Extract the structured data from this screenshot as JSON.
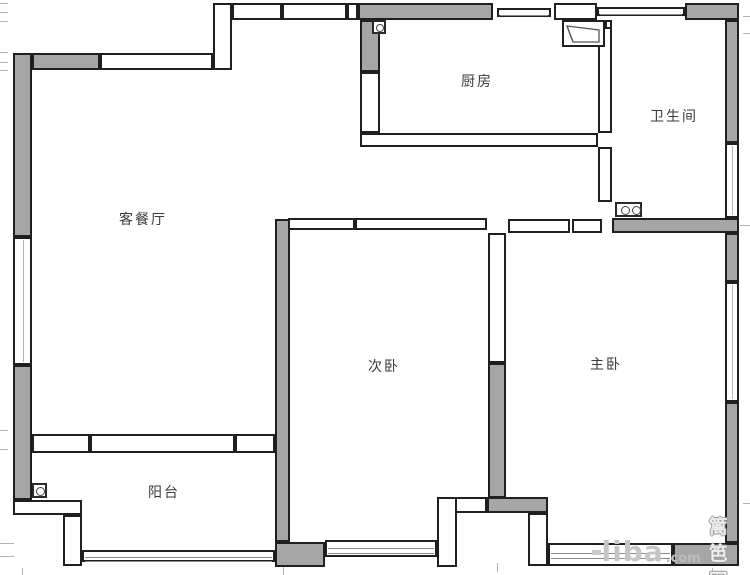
{
  "canvas": {
    "width": 750,
    "height": 575,
    "background": "#ffffff"
  },
  "colors": {
    "wall_fill": "#a6a6a6",
    "line": "#1f1f1f",
    "hollow_fill": "#ffffff",
    "tick": "#b3b3b3",
    "label": "#3a3a3a",
    "watermark_gray": "#c6c6c6"
  },
  "rooms": [
    {
      "id": "living-dining",
      "label": "客餐厅",
      "cx": 143,
      "cy": 219
    },
    {
      "id": "kitchen",
      "label": "厨房",
      "cx": 477,
      "cy": 81
    },
    {
      "id": "bathroom",
      "label": "卫生间",
      "cx": 674,
      "cy": 116
    },
    {
      "id": "second-bedroom",
      "label": "次卧",
      "cx": 384,
      "cy": 366
    },
    {
      "id": "master-bedroom",
      "label": "主卧",
      "cx": 606,
      "cy": 364
    },
    {
      "id": "balcony",
      "label": "阳台",
      "cx": 164,
      "cy": 492
    }
  ],
  "watermark": {
    "brand": "liba",
    "tld": ".com",
    "site": "篱笆网"
  },
  "plan": {
    "gray_walls": [
      [
        13,
        53,
        19,
        184
      ],
      [
        32,
        53,
        68,
        17
      ],
      [
        358,
        3,
        135,
        17
      ],
      [
        360,
        20,
        20,
        52
      ],
      [
        685,
        3,
        54,
        17
      ],
      [
        725,
        20,
        14,
        123
      ],
      [
        612,
        218,
        127,
        15
      ],
      [
        725,
        233,
        14,
        49
      ],
      [
        725,
        402,
        14,
        141
      ],
      [
        673,
        543,
        66,
        23
      ],
      [
        275,
        219,
        15,
        323
      ],
      [
        275,
        542,
        50,
        25
      ],
      [
        488,
        363,
        18,
        135
      ],
      [
        487,
        497,
        61,
        16
      ],
      [
        13,
        365,
        19,
        135
      ]
    ],
    "hollow_walls": [
      [
        100,
        53,
        113,
        17
      ],
      [
        213,
        3,
        19,
        67
      ],
      [
        232,
        3,
        50,
        17
      ],
      [
        282,
        3,
        65,
        17
      ],
      [
        347,
        3,
        11,
        17
      ],
      [
        554,
        3,
        43,
        17
      ],
      [
        360,
        72,
        20,
        61
      ],
      [
        360,
        133,
        238,
        14
      ],
      [
        598,
        20,
        14,
        113
      ],
      [
        598,
        147,
        14,
        55
      ],
      [
        288,
        218,
        67,
        12
      ],
      [
        355,
        218,
        132,
        12
      ],
      [
        488,
        233,
        18,
        130
      ],
      [
        508,
        219,
        62,
        14
      ],
      [
        572,
        219,
        30,
        14
      ],
      [
        32,
        434,
        58,
        19
      ],
      [
        90,
        434,
        145,
        19
      ],
      [
        235,
        434,
        40,
        19
      ],
      [
        13,
        500,
        69,
        15
      ],
      [
        63,
        515,
        19,
        51
      ],
      [
        437,
        497,
        50,
        16
      ],
      [
        437,
        497,
        20,
        70
      ],
      [
        528,
        513,
        20,
        53
      ],
      [
        605,
        20,
        7,
        9
      ]
    ],
    "windows_h": [
      {
        "r": [
          497,
          8,
          54,
          9
        ],
        "lines": [
          0.5
        ]
      },
      {
        "r": [
          597,
          7,
          88,
          9
        ],
        "lines": [
          0.5
        ]
      },
      {
        "r": [
          82,
          550,
          193,
          12
        ],
        "lines": [
          0.42,
          0.72
        ]
      },
      {
        "r": [
          325,
          540,
          112,
          17
        ],
        "lines": [
          0.35,
          0.62
        ]
      },
      {
        "r": [
          548,
          543,
          125,
          23
        ],
        "lines": [
          0.36,
          0.58
        ]
      }
    ],
    "windows_v": [
      {
        "r": [
          13,
          237,
          19,
          128
        ]
      },
      {
        "r": [
          725,
          143,
          14,
          75
        ]
      },
      {
        "r": [
          725,
          282,
          14,
          120
        ]
      }
    ],
    "icons": [
      {
        "type": "flue",
        "name": "flue-icon",
        "r": [
          372,
          20,
          14,
          14
        ]
      },
      {
        "type": "hood",
        "name": "range-hood-icon",
        "r": [
          562,
          20,
          43,
          27
        ]
      },
      {
        "type": "basin",
        "name": "double-basin-icon",
        "r": [
          615,
          202,
          27,
          15
        ]
      },
      {
        "type": "drain",
        "name": "floor-drain-icon",
        "r": [
          32,
          483,
          15,
          15
        ]
      }
    ],
    "ticks": [
      [
        0,
        3,
        8,
        1
      ],
      [
        0,
        12,
        8,
        1
      ],
      [
        0,
        21,
        8,
        1
      ],
      [
        0,
        52,
        8,
        1
      ],
      [
        0,
        62,
        8,
        1
      ],
      [
        0,
        70,
        8,
        1
      ],
      [
        0,
        430,
        8,
        1
      ],
      [
        0,
        449,
        8,
        1
      ],
      [
        0,
        543,
        14,
        1
      ],
      [
        0,
        556,
        14,
        1
      ],
      [
        22,
        568,
        1,
        7
      ],
      [
        283,
        567,
        1,
        8
      ],
      [
        497,
        563,
        1,
        9
      ],
      [
        712,
        568,
        1,
        7
      ],
      [
        743,
        16,
        7,
        1
      ],
      [
        743,
        33,
        7,
        1
      ],
      [
        740,
        225,
        10,
        1
      ],
      [
        743,
        503,
        7,
        1
      ]
    ]
  }
}
